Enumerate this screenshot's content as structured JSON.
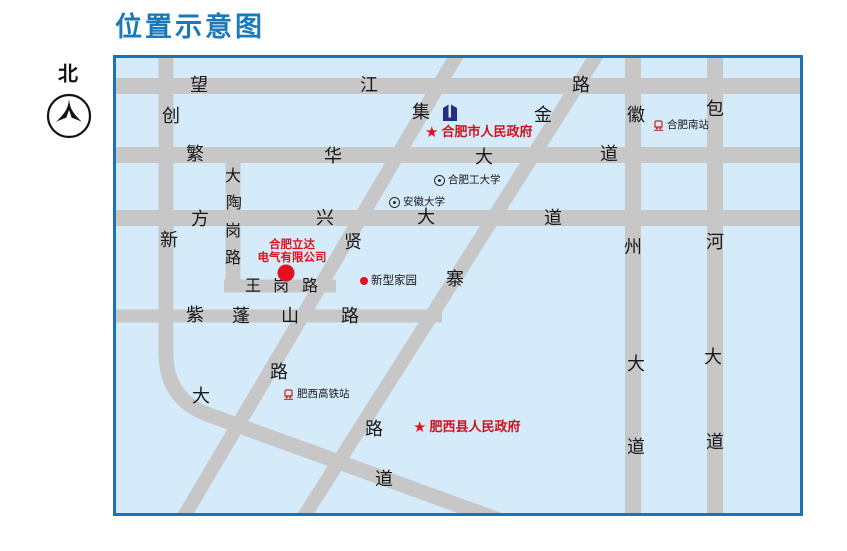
{
  "title": "位置示意图",
  "compass": {
    "label": "北"
  },
  "colors": {
    "title_blue": "#1b79ba",
    "map_border": "#1e72b4",
    "map_bg": "#d5ebf9",
    "road_gray": "#c7c7c8",
    "accent_red": "#e3101e",
    "building_navy": "#252e86"
  },
  "map": {
    "roads": [
      {
        "id": "wangjiang",
        "name": "望江路",
        "chars": [
          "望",
          "江",
          "路"
        ]
      },
      {
        "id": "fanhua",
        "name": "繁华大道",
        "chars": [
          "繁",
          "华",
          "大",
          "道"
        ]
      },
      {
        "id": "fangxing",
        "name": "方兴大道",
        "chars": [
          "方",
          "兴",
          "大",
          "道"
        ]
      },
      {
        "id": "wanggang",
        "name": "王岗路",
        "chars": [
          "王",
          "岗",
          "路"
        ]
      },
      {
        "id": "zipengshan",
        "name": "紫蓬山路",
        "chars": [
          "紫",
          "蓬",
          "山",
          "路"
        ]
      },
      {
        "id": "chuangxin",
        "name": "创新大道",
        "chars": [
          "创",
          "新",
          "大",
          "道"
        ]
      },
      {
        "id": "dataogang",
        "name": "大陶岗路",
        "chars": [
          "大",
          "陶",
          "岗",
          "路"
        ]
      },
      {
        "id": "jixian",
        "name": "集贤路",
        "chars": [
          "集",
          "贤",
          "路"
        ]
      },
      {
        "id": "jinzhai",
        "name": "金寨路",
        "chars": [
          "金",
          "寨",
          "路"
        ]
      },
      {
        "id": "huizhou",
        "name": "徽州大道",
        "chars": [
          "徽",
          "州",
          "大",
          "道"
        ]
      },
      {
        "id": "baohe",
        "name": "包河大道",
        "chars": [
          "包",
          "河",
          "大",
          "道"
        ]
      }
    ],
    "pois": {
      "city_gov": {
        "label": "合肥市人民政府"
      },
      "hfut": {
        "label": "合肥工大学"
      },
      "anhui_univ": {
        "label": "安徽大学"
      },
      "south_station": {
        "label": "合肥南站"
      },
      "xinxing": {
        "label": "新型家园"
      },
      "company": {
        "line1": "合肥立达",
        "line2": "电气有限公司"
      },
      "feixi_station": {
        "label": "肥西高铁站"
      },
      "county_gov": {
        "label": "肥西县人民政府"
      }
    }
  }
}
